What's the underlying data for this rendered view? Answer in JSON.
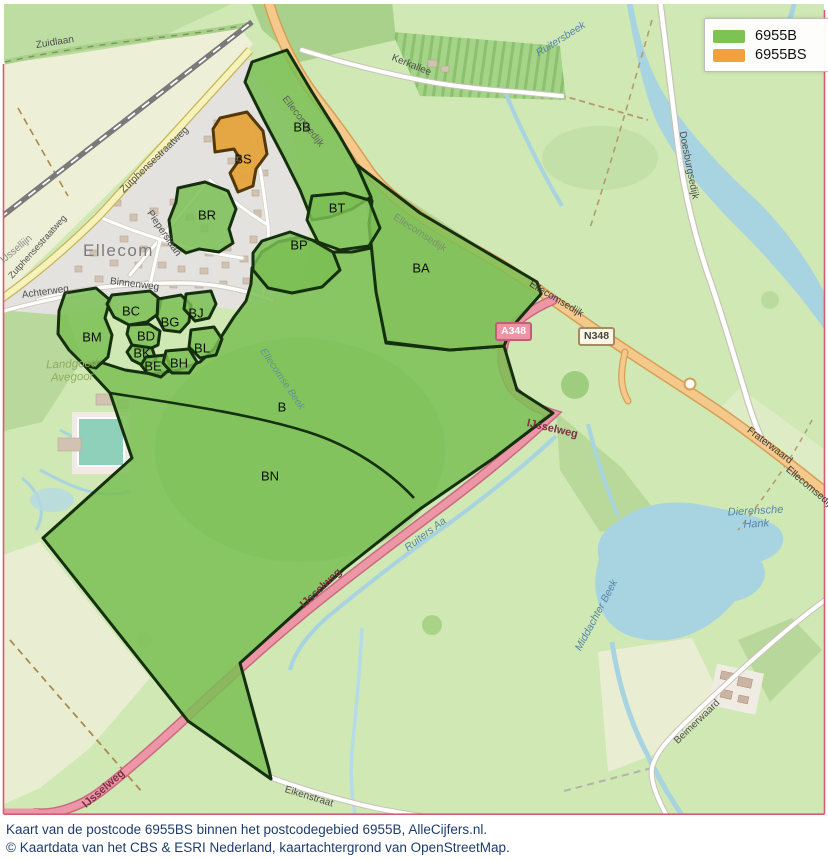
{
  "legend": {
    "items": [
      {
        "label": "6955B",
        "color": "#7dc353"
      },
      {
        "label": "6955BS",
        "color": "#f2a23c"
      }
    ]
  },
  "caption": {
    "line1": "Kaart van de postcode 6955BS binnen het postcodegebied 6955B, AlleCijfers.nl.",
    "line2": "© Kaartdata van het CBS & ESRI Nederland, kaartachtergrond van OpenStreetMap."
  },
  "shields": {
    "a348": "A348",
    "n348": "N348"
  },
  "area_labels": {
    "BB": "BB",
    "BS": "BS",
    "BR": "BR",
    "BT": "BT",
    "BP": "BP",
    "BA": "BA",
    "BM": "BM",
    "BC": "BC",
    "BD": "BD",
    "BK": "BK",
    "BE": "BE",
    "BH": "BH",
    "BG": "BG",
    "BJ": "BJ",
    "BL": "BL",
    "B": "B",
    "BN": "BN"
  },
  "places": {
    "town": "Ellecom",
    "estate_line1": "Landgoed",
    "estate_line2": "Avegoor"
  },
  "streets": {
    "zuidlaan": "Zuidlaan",
    "kerkallee": "Kerkallee",
    "zutphensestraatweg": "Zutphensestraatweg",
    "ijssellijn": "IJssellijn",
    "pieperslaan": "Pieperslaan",
    "achterweg": "Achterweg",
    "binnenweg": "Binnenweg",
    "ellecomsedijk": "Ellecomsedijk",
    "doesburgsedijk": "Doesburgsedijk",
    "ijsselweg": "IJsselweg",
    "eikenstraat": "Eikenstraat",
    "beimerwaard": "Beimerwaard",
    "fraterwaard": "Fraterwaard"
  },
  "waters": {
    "ruitersbeek": "Ruitersbeek",
    "ruiters_aa": "Ruiters Aa",
    "dierensche_line1": "Dierensche",
    "dierensche_line2": "Hank",
    "middachter_beek": "Middachter Beek",
    "ellecomse_beek": "Ellecomse Beek"
  },
  "colors": {
    "overlay_green": "#79bf52",
    "overlay_orange": "#e5a23b",
    "overlay_border": "#15300e",
    "water": "#a8d3e0",
    "motorway": "#ec96a6",
    "primary_road": "#f5c98b",
    "frame": "#d95b72",
    "caption_text": "#1d3c6e"
  }
}
